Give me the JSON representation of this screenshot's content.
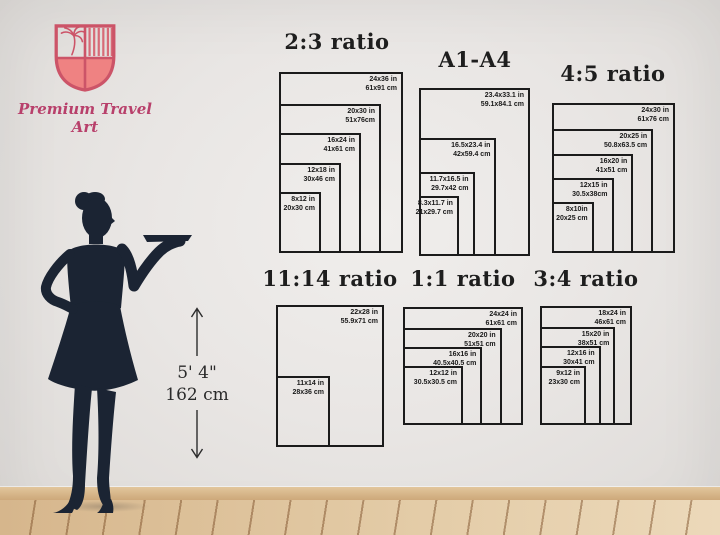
{
  "brand": {
    "name": "Premium Travel Art"
  },
  "height_marker": {
    "imperial": "5' 4\"",
    "metric": "162 cm"
  },
  "colors": {
    "accent_rose": "#cc5468",
    "shield_fill": "#ef8282",
    "brand_pink": "#b8406b",
    "diagram_line": "#1b1b1b",
    "silhouette_navy": "#1b2433",
    "floor_wood": "#dcc09a"
  },
  "diagrams": [
    {
      "title": "2:3 ratio",
      "outer_in": {
        "w": 24,
        "h": 36
      },
      "sizes": [
        {
          "in": "24x36 in",
          "cm": "61x91 cm",
          "w": 24,
          "h": 36
        },
        {
          "in": "20x30 in",
          "cm": "51x76cm",
          "w": 20,
          "h": 30
        },
        {
          "in": "16x24 in",
          "cm": "41x61 cm",
          "w": 16,
          "h": 24
        },
        {
          "in": "12x18 in",
          "cm": "30x46 cm",
          "w": 12,
          "h": 18
        },
        {
          "in": "8x12 in",
          "cm": "20x30 cm",
          "w": 8,
          "h": 12
        }
      ]
    },
    {
      "title": "A1-A4",
      "outer_in": {
        "w": 23.4,
        "h": 33.1
      },
      "sizes": [
        {
          "in": "23.4x33.1 in",
          "cm": "59.1x84.1 cm",
          "w": 23.4,
          "h": 33.1
        },
        {
          "in": "16.5x23.4 in",
          "cm": "42x59.4 cm",
          "w": 16.5,
          "h": 23.4
        },
        {
          "in": "11.7x16.5 in",
          "cm": "29.7x42 cm",
          "w": 11.7,
          "h": 16.5
        },
        {
          "in": "8.3x11.7 in",
          "cm": "21x29.7 cm",
          "w": 8.3,
          "h": 11.7
        }
      ]
    },
    {
      "title": "4:5 ratio",
      "outer_in": {
        "w": 24,
        "h": 30
      },
      "sizes": [
        {
          "in": "24x30 in",
          "cm": "61x76 cm",
          "w": 24,
          "h": 30
        },
        {
          "in": "20x25 in",
          "cm": "50.8x63.5 cm",
          "w": 20,
          "h": 25
        },
        {
          "in": "16x20 in",
          "cm": "41x51 cm",
          "w": 16,
          "h": 20
        },
        {
          "in": "12x15 in",
          "cm": "30.5x38cm",
          "w": 12,
          "h": 15
        },
        {
          "in": "8x10in",
          "cm": "20x25 cm",
          "w": 8,
          "h": 10
        }
      ]
    },
    {
      "title": "11:14 ratio",
      "outer_in": {
        "w": 22,
        "h": 28
      },
      "sizes": [
        {
          "in": "22x28 in",
          "cm": "55.9x71 cm",
          "w": 22,
          "h": 28
        },
        {
          "in": "11x14 in",
          "cm": "28x36 cm",
          "w": 11,
          "h": 14
        }
      ]
    },
    {
      "title": "1:1 ratio",
      "outer_in": {
        "w": 24,
        "h": 24
      },
      "sizes": [
        {
          "in": "24x24 in",
          "cm": "61x61 cm",
          "w": 24,
          "h": 24
        },
        {
          "in": "20x20 in",
          "cm": "51x51 cm",
          "w": 20,
          "h": 20
        },
        {
          "in": "16x16 in",
          "cm": "40.5x40.5 cm",
          "w": 16,
          "h": 16
        },
        {
          "in": "12x12 in",
          "cm": "30.5x30.5 cm",
          "w": 12,
          "h": 12
        }
      ]
    },
    {
      "title": "3:4 ratio",
      "outer_in": {
        "w": 18,
        "h": 24
      },
      "sizes": [
        {
          "in": "18x24 in",
          "cm": "46x61 cm",
          "w": 18,
          "h": 24
        },
        {
          "in": "15x20 in",
          "cm": "38x51 cm",
          "w": 15,
          "h": 20
        },
        {
          "in": "12x16 in",
          "cm": "30x41 cm",
          "w": 12,
          "h": 16
        },
        {
          "in": "9x12 in",
          "cm": "23x30 cm",
          "w": 9,
          "h": 12
        }
      ]
    }
  ]
}
